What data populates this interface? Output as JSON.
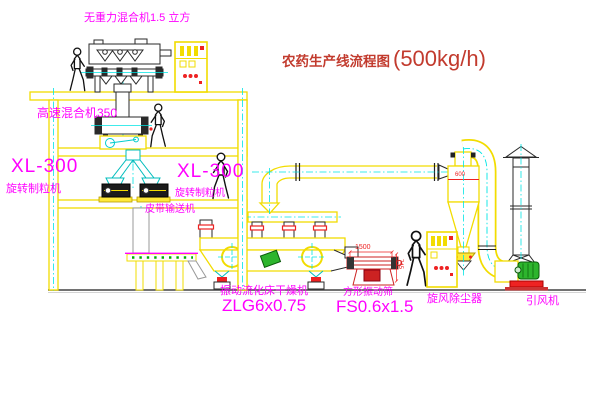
{
  "title": {
    "text": "农药生产线流程图",
    "capacity": "(500kg/h)"
  },
  "labels": {
    "gravity_mixer": "无重力混合机1.5 立方",
    "high_speed_mixer": "高速混合机350",
    "granulator_left_model": "XL-300",
    "granulator_left_name": "旋转制粒机",
    "granulator_right_model": "XL-300",
    "granulator_right_name": "旋转制粒机",
    "belt_conveyor": "皮带输送机",
    "dryer_name": "振动流化床干燥机",
    "dryer_model": "ZLG6x0.75",
    "sieve_name": "方形振动筛",
    "sieve_model": "FS0.6x1.5",
    "cyclone": "旋风除尘器",
    "fan": "引风机"
  },
  "dimensions": {
    "sieve_length": "1500",
    "sieve_height": "745",
    "cyclone_size": "600"
  },
  "colors": {
    "structure_yellow": "#f2dc00",
    "centerline_cyan": "#00e5e5",
    "label_magenta": "#ff00ff",
    "title_red": "#c23b2e",
    "dimension_red": "#ee2222",
    "machine_green": "#2db52d"
  }
}
